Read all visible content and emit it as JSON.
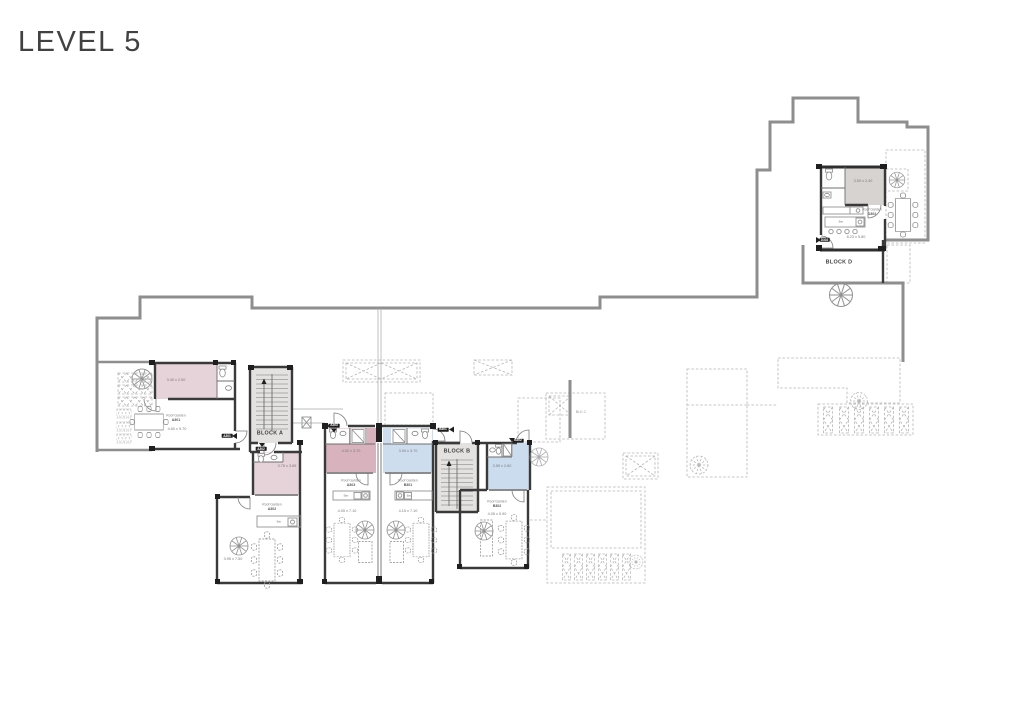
{
  "title": "LEVEL 5",
  "blocks": {
    "a": "BLOCK A",
    "b": "BLOCK B",
    "c": "BLK C",
    "d": "BLOCK D"
  },
  "garden_label": "Roof Garden",
  "bar_label": "Bar",
  "units": {
    "a301": {
      "tag": "A301",
      "no": "A301",
      "room_dim": "3.40 x 2.50",
      "garden_dim": "4.60 x 5.70"
    },
    "a302": {
      "tag": "A302",
      "no": "A302",
      "room_dim": "3.75 x 3.65",
      "garden_dim": "3.95 x 7.50"
    },
    "a303": {
      "tag": "A303",
      "no": "A303",
      "room_dim": "4.02 x 3.70",
      "garden_dim": "4.05 x 7.10"
    },
    "b301": {
      "tag": "B301",
      "no": "B301",
      "room_dim": "3.94 x 3.70",
      "garden_dim": "4.15 x 7.10"
    },
    "b302": {
      "tag": "B302",
      "no": "B302",
      "room_dim": "3.55 x 2.60",
      "garden_dim": "4.05 x 5.90"
    },
    "d302": {
      "tag": "D302",
      "no": "D302",
      "room_dim": "3.50 x 2.40",
      "garden_dim": "8.23 x 5.80"
    }
  },
  "colors": {
    "pink_room": "#d8b2bc",
    "pink_room_light": "#e6d2d9",
    "blue_room": "#cdddee",
    "gray_room": "#d7d3d0",
    "wall": "#3a3a3a",
    "outline": "#8e8e8e",
    "dashed": "#b5b5b5"
  }
}
